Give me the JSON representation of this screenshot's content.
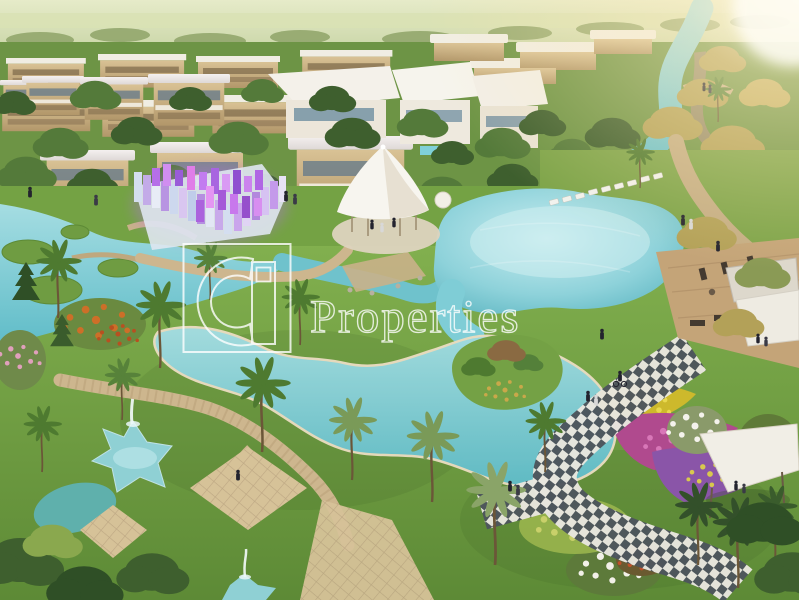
{
  "watermark": {
    "brand_text": "Properties",
    "logo_icon": "g-building-emblem",
    "color": "#ffffff",
    "opacity": 0.8
  },
  "scene": {
    "type": "aerial-architectural-render",
    "alt": "Aerial rendering of a master-planned villa community: rows of beige flat-roof villas, turquoise lagoons and canals, palm-dotted lawns, an illuminated violet glass maze, a white event tent, star-shaped fountain ponds, flower gardens, a checkered mosaic promenade, waterside decks and a warm sun glow from the top right",
    "elements": [
      "villas",
      "townhouse-rows",
      "winding-river",
      "central-lagoon",
      "lower-lagoon",
      "glass-maze",
      "event-tent",
      "star-pond",
      "fountain",
      "palm-trees",
      "flower-beds",
      "checker-path",
      "promenade",
      "wood-deck",
      "lounge-chairs",
      "white-canopy",
      "people",
      "sun-glow"
    ]
  },
  "palette": {
    "water": "#7fcdd6",
    "water_light": "#bfe8ec",
    "water_deep": "#4fa9b8",
    "grass": "#7aa647",
    "grass_dark": "#4f7a2e",
    "tree_dark": "#3e5f2e",
    "tree_gold": "#b3a158",
    "building_beige": "#c9ad7d",
    "roof_white": "#f3f1ea",
    "maze_purple": "#b66fe8",
    "tent_white": "#f6f4ee",
    "path_tan": "#c9b18a",
    "checker_dark": "#4d555c",
    "checker_light": "#e8e6de",
    "sun_glow": "#fff3d8",
    "flower_magenta": "#b04a8e",
    "flower_yellow": "#cdb92c",
    "flower_orange": "#cd6f28",
    "watermark_white": "#ffffff"
  }
}
